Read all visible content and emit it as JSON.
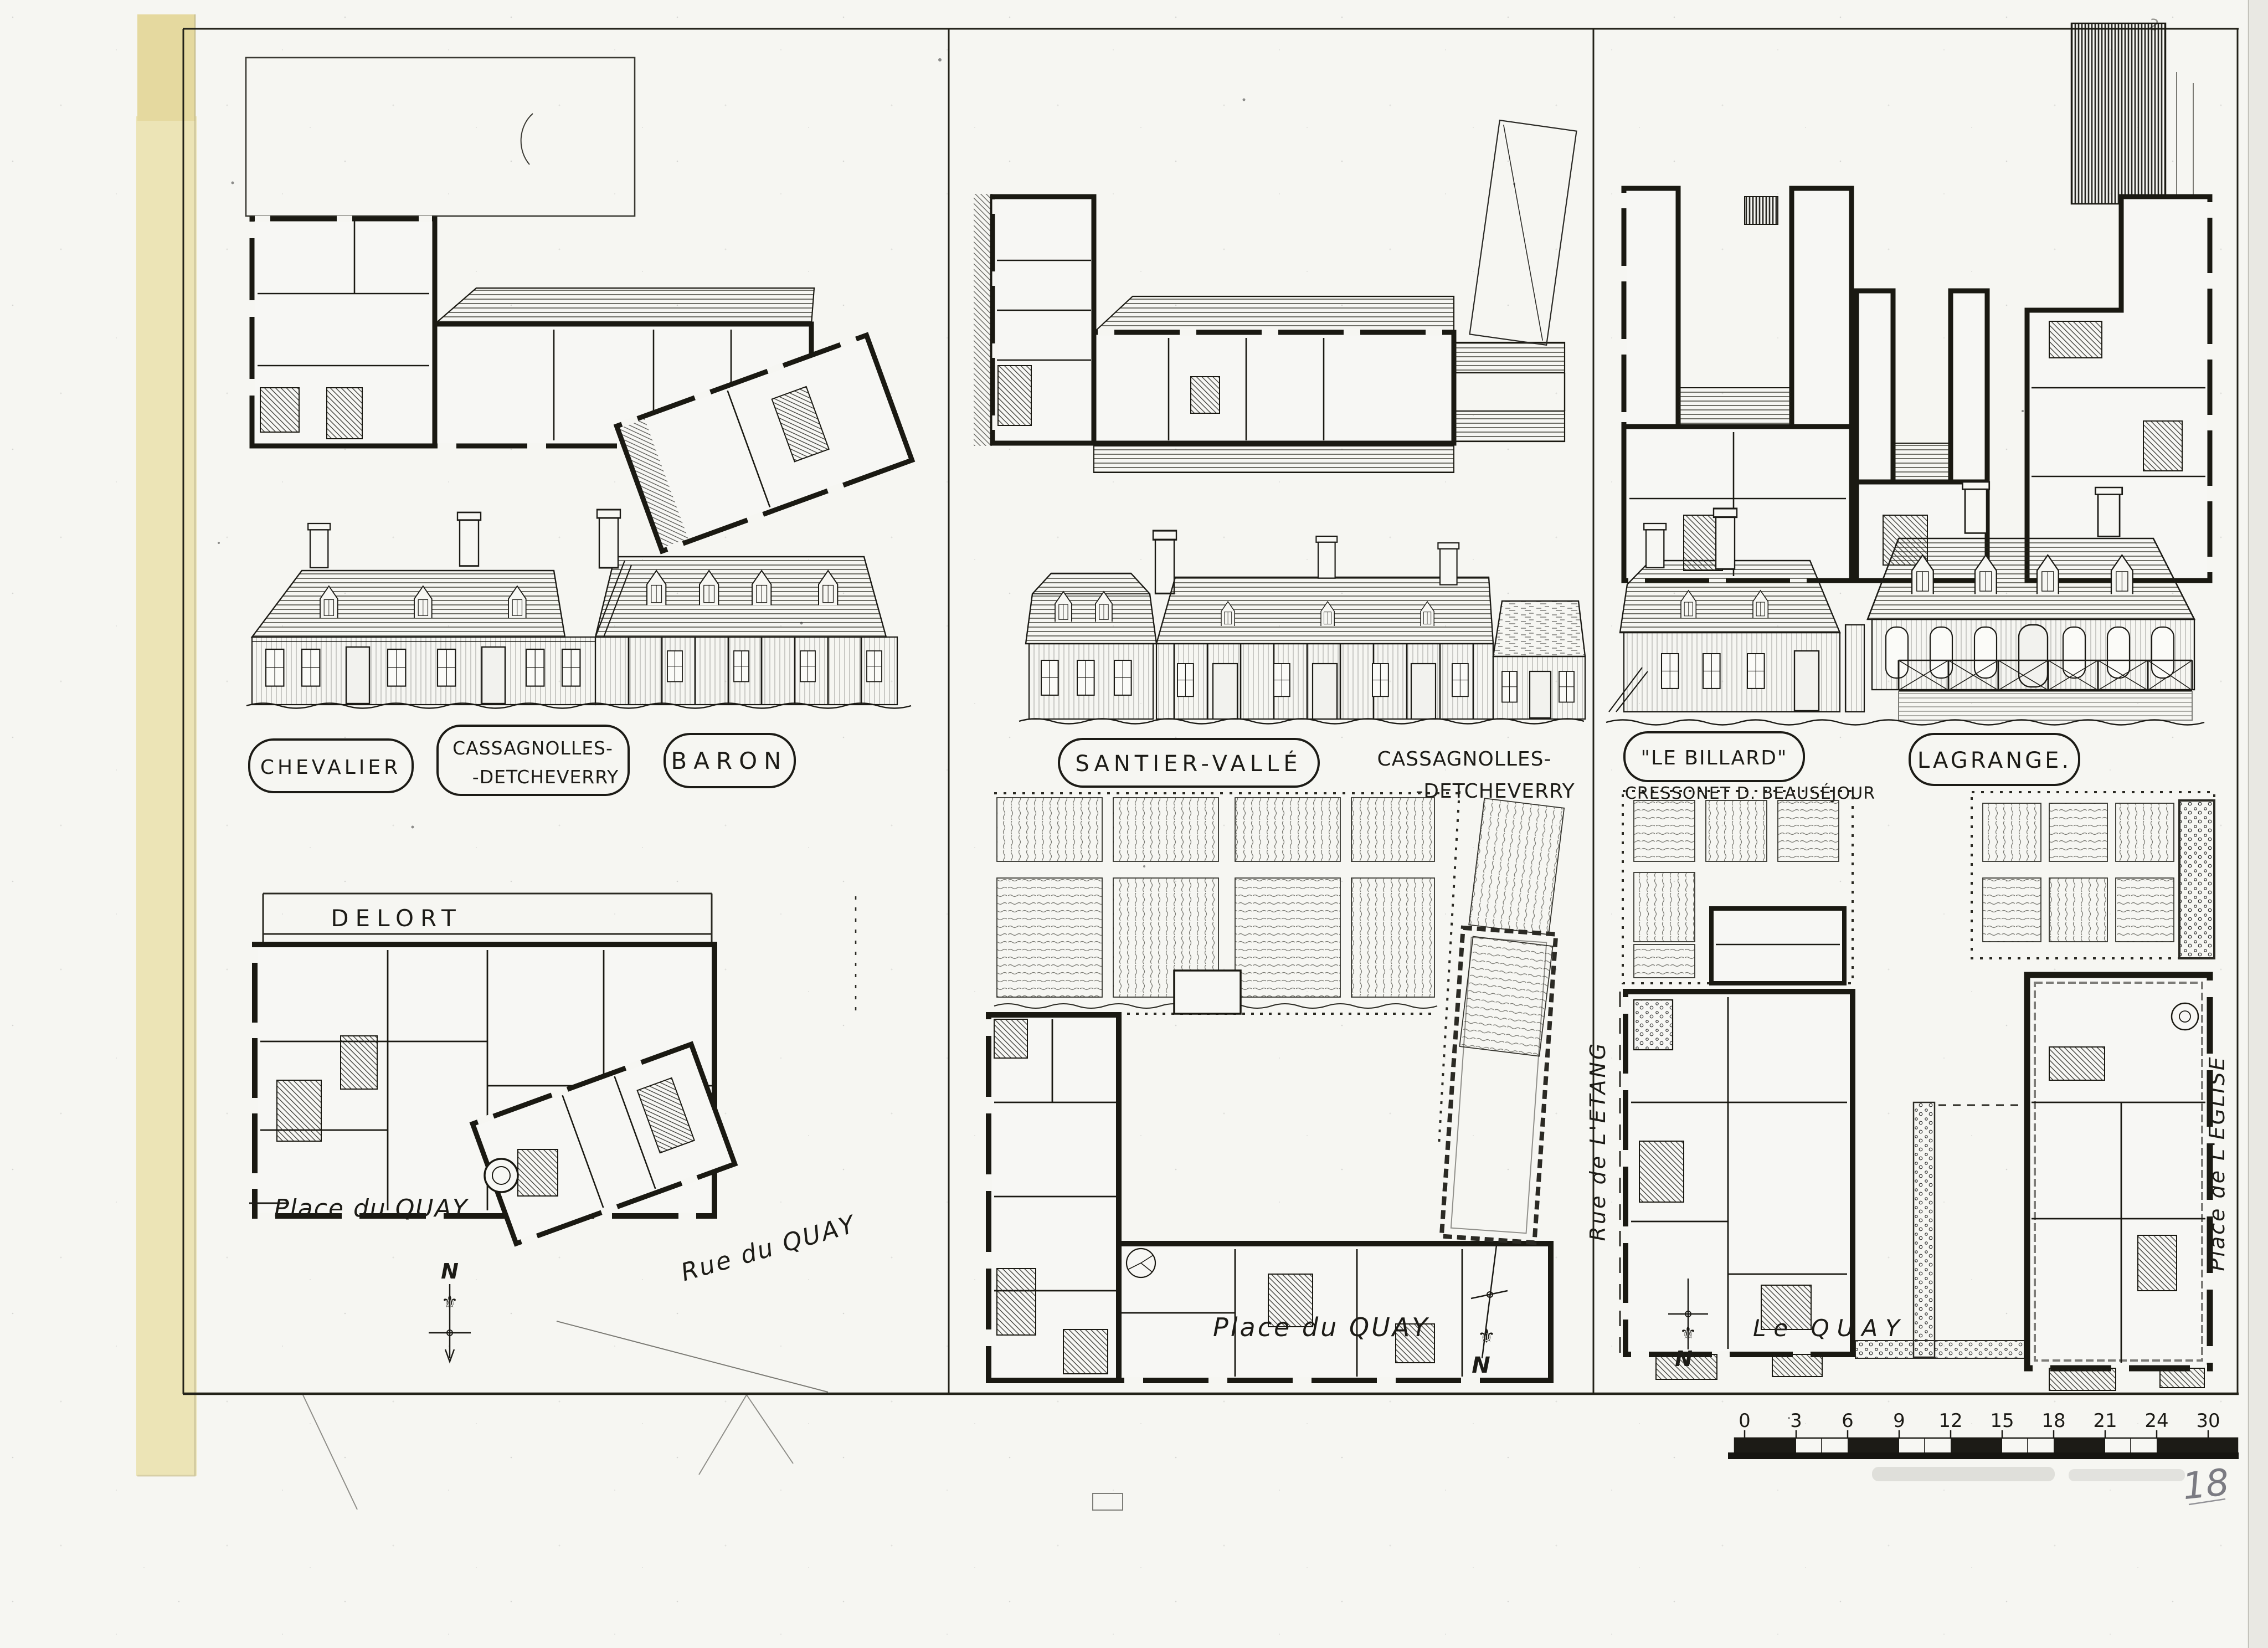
{
  "sheet": {
    "page_number": "18",
    "north_letter": "N",
    "fleur_icon": "⚜",
    "corner_mark": "2",
    "scale_ticks": [
      "0",
      "3",
      "6",
      "9",
      "12",
      "15",
      "18",
      "21",
      "24",
      "30"
    ]
  },
  "panel_left": {
    "labels": {
      "chevalier": "CHEVALIER",
      "cassagnolles_line1": "CASSAGNOLLES-",
      "cassagnolles_line2": "-DETCHEVERRY",
      "baron": "BARON"
    },
    "site": {
      "delort": "DELORT",
      "place_du_quay": "Place du QUAY",
      "rue_du_quay": "Rue du QUAY"
    }
  },
  "panel_middle": {
    "labels": {
      "santier_valle": "SANTIER-VALLÉ",
      "cassagnolles_line1": "CASSAGNOLLES-",
      "cassagnolles_line2": "-DETCHEVERRY"
    },
    "site": {
      "place_du_quay": "Place du QUAY"
    }
  },
  "panel_right": {
    "labels": {
      "le_billard": "\"LE BILLARD\"",
      "cressonet": "CRESSONET D. BEAUSÉJOUR",
      "lagrange": "LAGRANGE."
    },
    "site": {
      "rue_de_letang": "Rue de L'ETANG",
      "le_quay": "Le QUAY",
      "place_de_leglise": "Place de L'EGLISE"
    }
  }
}
